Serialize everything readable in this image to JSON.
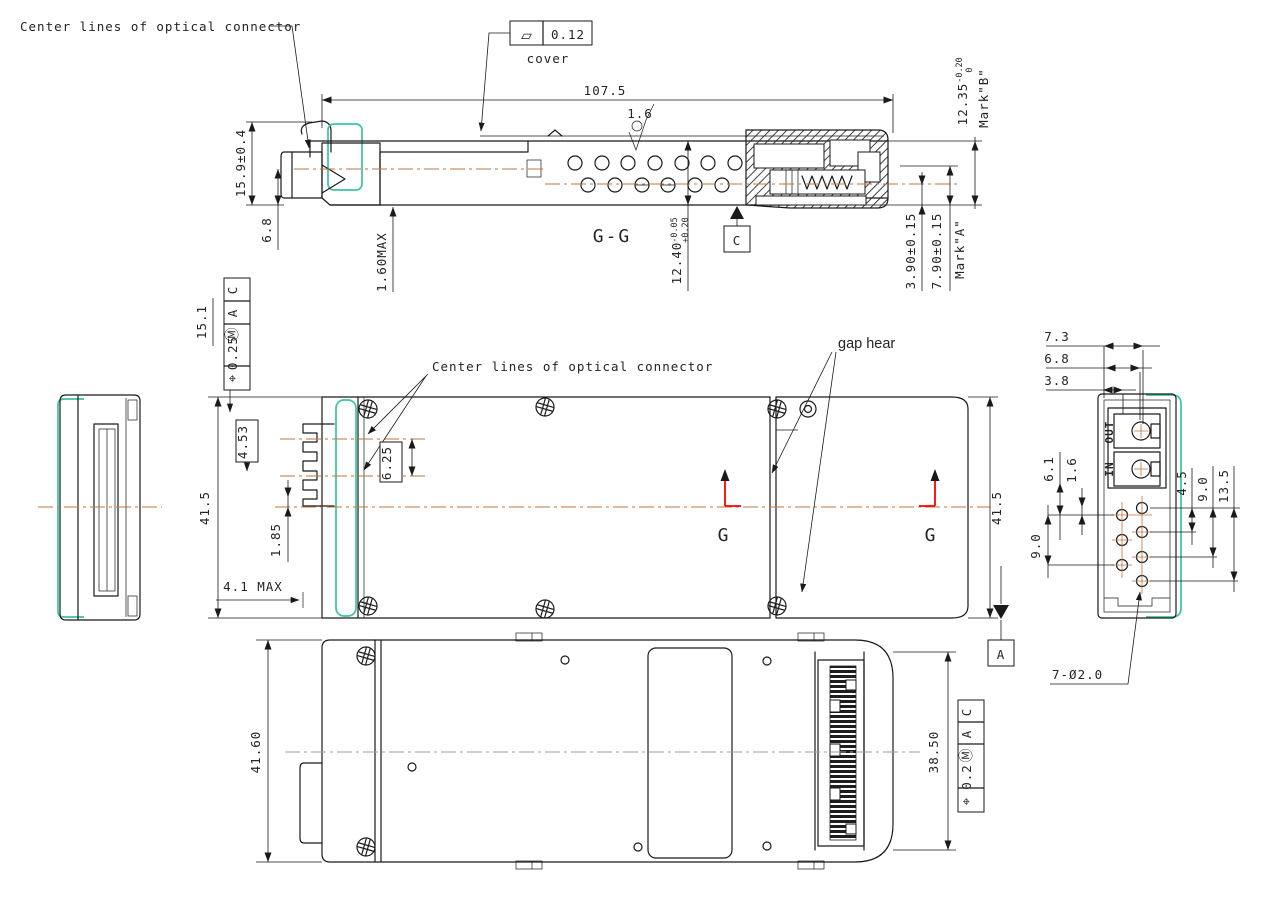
{
  "drawing": {
    "description": "Multi-view mechanical engineering drawing of an optical transceiver module with GD&T",
    "views": [
      "section G-G side view",
      "left end view",
      "top view",
      "right end view",
      "bottom view"
    ]
  },
  "colors": {
    "line": "#1a1a1a",
    "teal_outline": "#3cc4a2",
    "centerline_orange": "#c0763c",
    "centerline_gray": "#97a09c",
    "section_red": "#ff0000",
    "background": "#ffffff"
  },
  "labels": {
    "note_center_lines_top": "Center lines of optical connector",
    "note_center_lines_mid": "Center lines of optical connector",
    "flatness_symbol": "▱",
    "flatness_value": "0.12",
    "cover": "cover",
    "dim_107_5": "107.5",
    "roughness_1_6": "1.6",
    "dim_12_35": "12.35",
    "dim_12_35_tol_hi": "0",
    "dim_12_35_tol_lo": "-0.20",
    "mark_b": "Mark\"B\"",
    "dim_15_9": "15.9±0.4",
    "dim_6_8_side": "6.8",
    "dim_1_60_max": "1.60MAX",
    "section_gg": "G-G",
    "dim_12_40": "12.40",
    "dim_12_40_tol_hi": "+0.20",
    "dim_12_40_tol_lo": "-0.05",
    "datum_c": "C",
    "dim_3_90": "3.90±0.15",
    "dim_7_90": "7.90±0.15",
    "mark_a": "Mark\"A\"",
    "fcf_top": {
      "symbol": "⌖",
      "value": "0.25",
      "modifier": "Ⓜ",
      "datum_a": "A",
      "datum_c": "C"
    },
    "dim_15_1": "15.1",
    "dim_4_53": "4.53",
    "dim_6_25": "6.25",
    "dim_41_5_left": "41.5",
    "dim_1_85": "1.85",
    "dim_4_1_max": "4.1 MAX",
    "gap_hear": "gap hear",
    "section_g_left": "G",
    "section_g_right": "G",
    "dim_41_5_right": "41.5",
    "datum_a": "A",
    "dim_7_3": "7.3",
    "dim_6_8_end": "6.8",
    "dim_3_8": "3.8",
    "port_out": "OUT",
    "port_in": "IN",
    "dim_6_1": "6.1",
    "dim_1_6": "1.6",
    "dim_9_0_left": "9.0",
    "dim_4_5": "4.5",
    "dim_9_0_right": "9.0",
    "dim_13_5": "13.5",
    "holes_callout": "7-Ø2.0",
    "dim_41_60": "41.60",
    "dim_38_50": "38.50",
    "fcf_bottom": {
      "symbol": "⌖",
      "value": "0.2",
      "modifier": "Ⓜ",
      "datum_a": "A",
      "datum_c": "C"
    }
  }
}
